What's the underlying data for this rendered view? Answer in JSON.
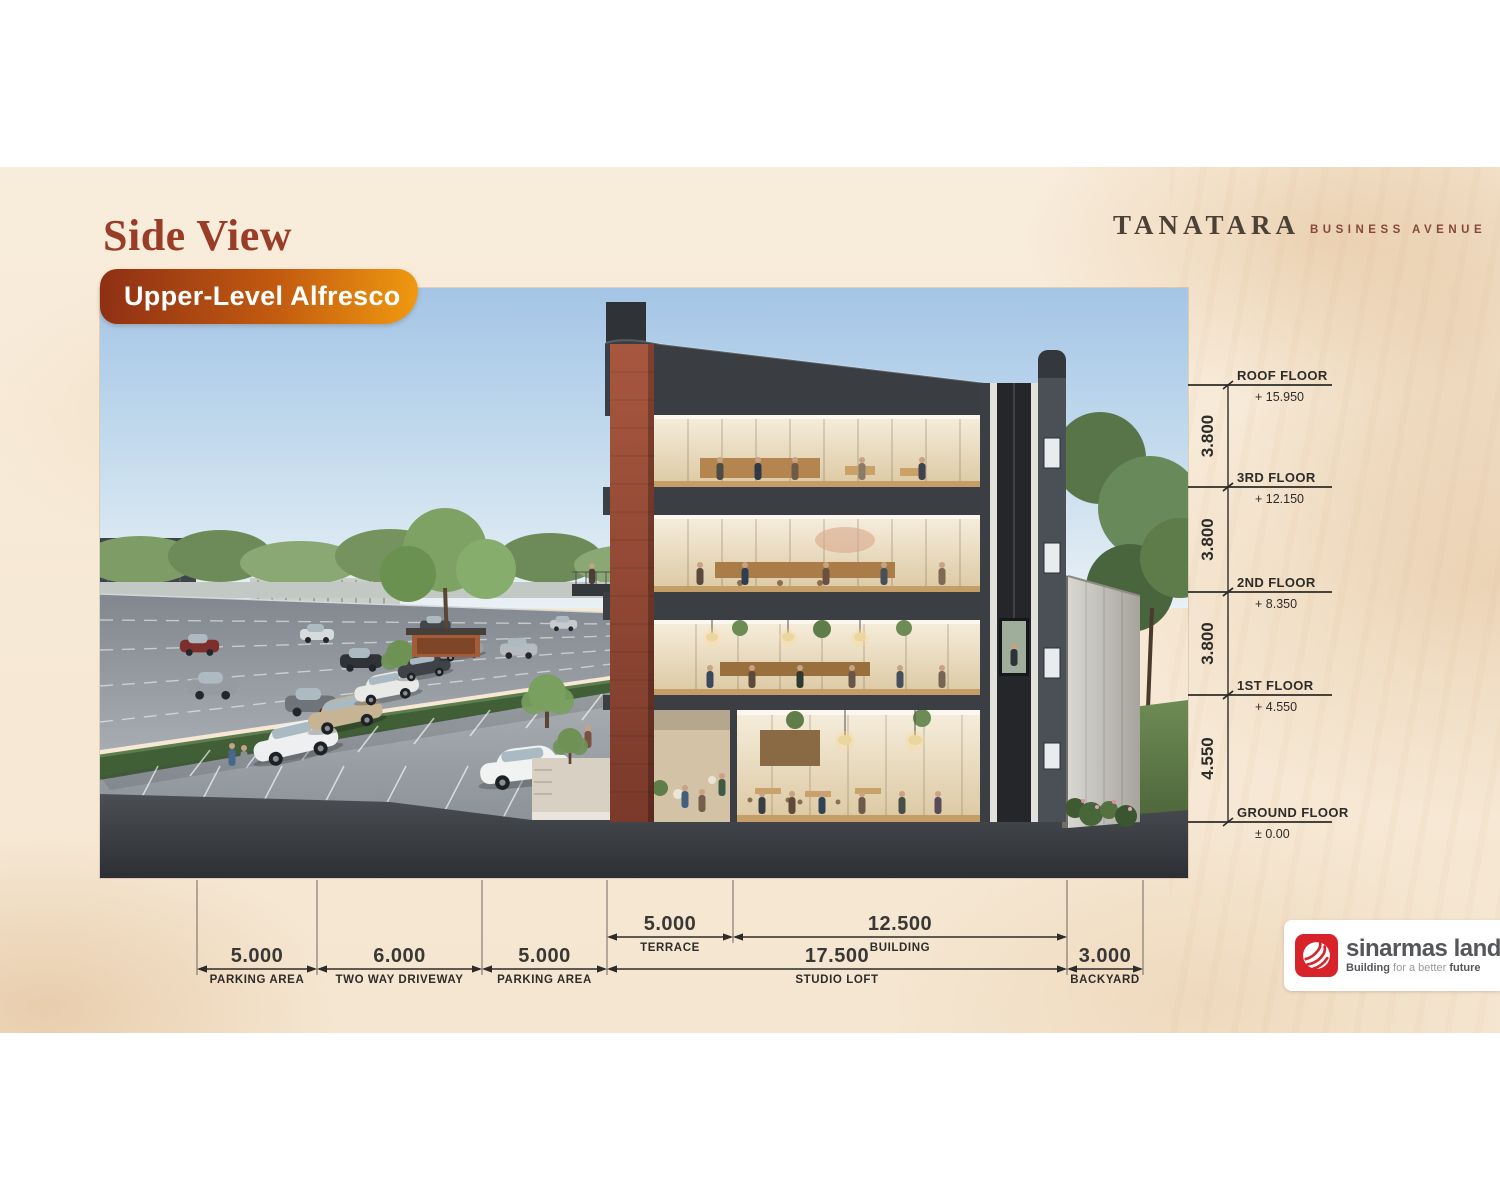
{
  "header": {
    "title": "Side View",
    "badge_label": "Upper-Level Alfresco",
    "brand_name": "TANATARA",
    "brand_suffix": "BUSINESS AVENUE"
  },
  "colors": {
    "title_ink": "#993c28",
    "badge_gradient_start": "#8e2f14",
    "badge_gradient_end": "#f09a10",
    "slide_background": "#f7e9d6",
    "annotation_ink": "#2e2c29",
    "sinarmas_red": "#d9232a"
  },
  "elevations": {
    "floors": [
      {
        "label": "ROOF FLOOR",
        "value": "+ 15.950",
        "y": 385
      },
      {
        "label": "3RD FLOOR",
        "value": "+ 12.150",
        "y": 487
      },
      {
        "label": "2ND FLOOR",
        "value": "+ 8.350",
        "y": 592
      },
      {
        "label": "1ST FLOOR",
        "value": "+ 4.550",
        "y": 695
      },
      {
        "label": "GROUND FLOOR",
        "value": "± 0.00",
        "y": 822
      }
    ],
    "storey_heights": [
      "3.800",
      "3.800",
      "3.800",
      "4.550"
    ]
  },
  "dimensions": {
    "upper_row": [
      {
        "value": "5.000",
        "label": "TERRACE",
        "x1": 607,
        "x2": 733
      },
      {
        "value": "12.500",
        "label": "BUILDING",
        "x1": 733,
        "x2": 1067
      }
    ],
    "lower_row": [
      {
        "value": "5.000",
        "label": "PARKING AREA",
        "x1": 197,
        "x2": 317
      },
      {
        "value": "6.000",
        "label": "TWO WAY DRIVEWAY",
        "x1": 317,
        "x2": 482
      },
      {
        "value": "5.000",
        "label": "PARKING AREA",
        "x1": 482,
        "x2": 607
      },
      {
        "value": "17.500",
        "label": "STUDIO LOFT",
        "x1": 607,
        "x2": 1067
      },
      {
        "value": "3.000",
        "label": "BACKYARD",
        "x1": 1067,
        "x2": 1143
      }
    ]
  },
  "footer": {
    "logo_name": "sinarmas land",
    "tagline_bold1": "Building",
    "tagline_light": " for a better ",
    "tagline_bold2": "future"
  }
}
